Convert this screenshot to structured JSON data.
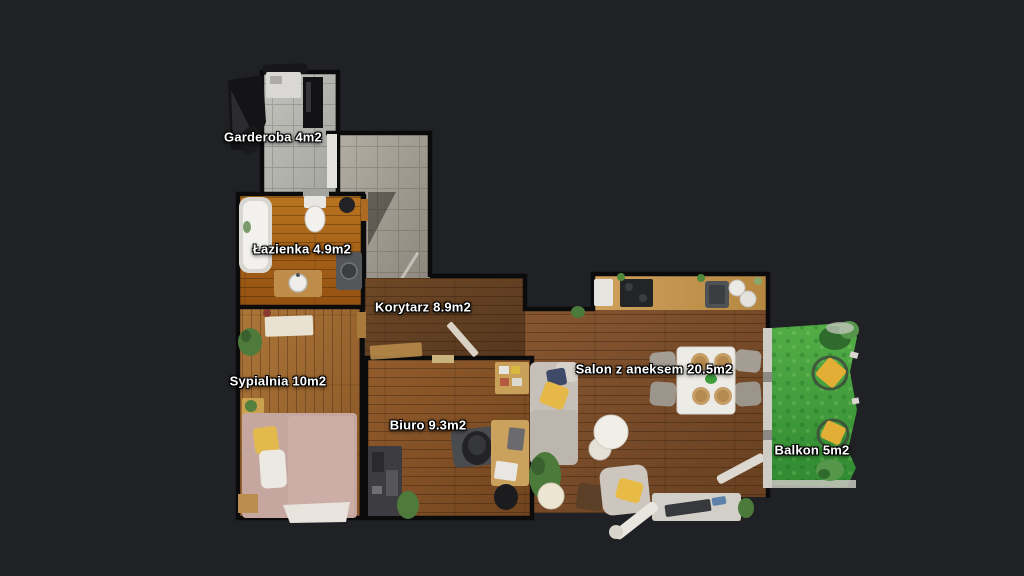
{
  "background_color": "#1f2124",
  "floorplan": {
    "type": "apartment-top-down-floorplan",
    "rooms": [
      {
        "id": "garderoba",
        "name": "Garderoba",
        "area": "4m2",
        "label": "Garderoba 4m2"
      },
      {
        "id": "lazienka",
        "name": "Łazienka",
        "area": "4.9m2",
        "label": "Łazienka 4.9m2"
      },
      {
        "id": "korytarz",
        "name": "Korytarz",
        "area": "8.9m2",
        "label": "Korytarz 8.9m2"
      },
      {
        "id": "sypialnia",
        "name": "Sypialnia",
        "area": "10m2",
        "label": "Sypialnia 10m2"
      },
      {
        "id": "biuro",
        "name": "Biuro",
        "area": "9.3m2",
        "label": "Biuro 9.3m2"
      },
      {
        "id": "salon",
        "name": "Salon z aneksem",
        "area": "20.5m2",
        "label": "Salon z aneksem 20.5m2"
      },
      {
        "id": "balkon",
        "name": "Balkon",
        "area": "5m2",
        "label": "Balkon 5m2"
      }
    ],
    "colors": {
      "background": "#1f2124",
      "wall": "#0b0b0c",
      "label_text": "#ffffff",
      "label_outline": "#000000",
      "tile_light": "#b6b7b2",
      "tile_entry": "#a49e95",
      "wood_bathroom": "#b06a1e",
      "wood_corridor": "#6b4524",
      "wood_bedroom": "#a06c34",
      "wood_office": "#8a5527",
      "wood_livingroom": "#7d4f28",
      "kitchen_counter": "#c79a55",
      "balcony_grass": "#44a03c",
      "cushion_yellow": "#e5b33c",
      "bed_linen": "#c5a7a0",
      "sofa_gray": "#c6c0b8"
    }
  }
}
